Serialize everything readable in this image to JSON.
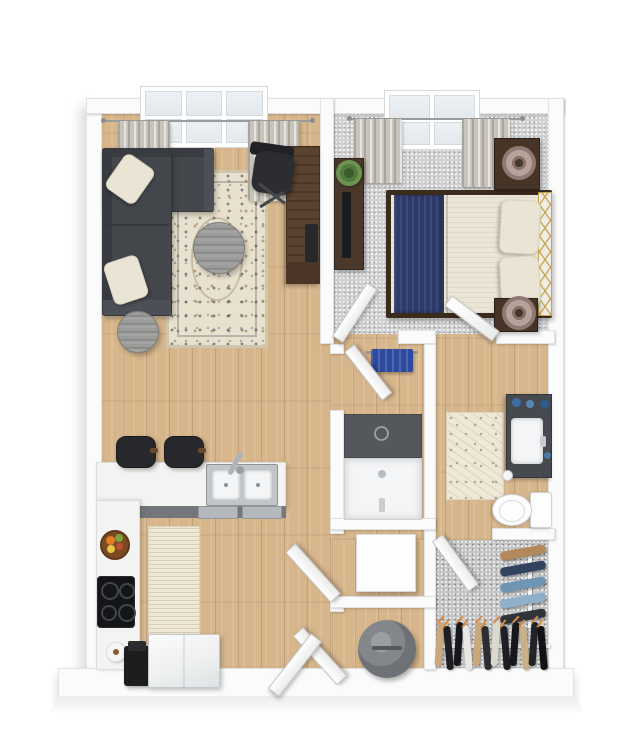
{
  "scene": {
    "type": "3d-floor-plan",
    "view": "top-down",
    "description": "One-bedroom apartment 3D floor plan with living room, bedroom, kitchen, bathroom, walk-in closet and utility closets"
  },
  "palette": {
    "background": "#ffffff",
    "wall": "#fbfbfb",
    "wall_edge": "#e2e2e2",
    "wood_floor": "#d7b68c",
    "carpet_bedroom": "#d0d1d2",
    "carpet_closet": "#c3c4c5",
    "sofa": "#43474c",
    "sofa_shadow": "#383b40",
    "sofa_arm": "#4c5056",
    "pillow_cream": "#e9e4d4",
    "rug_base": "#e8e1cd",
    "table_gray": "#979795",
    "desk_wood": "#5a4330",
    "desk_wood_dark": "#4a3526",
    "chair_black": "#2b2d30",
    "curtain": "#c9c4bb",
    "bed_frame": "#3b2b1c",
    "mattress": "#eae5d6",
    "navy_runner": "#2e3a6a",
    "nightstand": "#463426",
    "lamp_shade": "#b7a19b",
    "console_wood": "#4a382a",
    "tv_black": "#1b1d1f",
    "plant_green": "#527a3c",
    "counter_white": "#f3f3f2",
    "counter_edge": "#73767a",
    "stainless": "#b5b9bd",
    "sink_steel": "#c3c6c9",
    "basin_white": "#f4f5f6",
    "cooktop_black": "#141517",
    "stool_black": "#26282b",
    "stool_arm": "#6b4a2e",
    "fridge_white": "#f0f2f3",
    "bowl_brown": "#7a4a22",
    "fruit_orange": "#e07b28",
    "fruit_green": "#7aa33a",
    "fruit_yellow": "#e8c63f",
    "fruit_red": "#c24d35",
    "coffee_maker": "#1c1d1f",
    "plate_white": "#f6f6f6",
    "towel_blue": "#2d4a9e",
    "tile_dark": "#54575c",
    "tub_white": "#f4f5f6",
    "vanity_dark": "#46494d",
    "toilet_white": "#fdfdfe",
    "soap_blue": "#3b6ea5",
    "washer_white": "#fdfdfd",
    "heater_gray": "#83868a",
    "rod_white": "#f4f4f4",
    "hanger_orange": "#d98a3f",
    "headboard_gold": "#c9a84a"
  },
  "rooms": [
    {
      "name": "living-room",
      "floor": "hardwood",
      "items": [
        "sectional-sofa",
        "throw-pillow",
        "throw-pillow",
        "area-rug",
        "round-coffee-table",
        "round-side-table",
        "desk",
        "office-chair",
        "window",
        "curtains"
      ]
    },
    {
      "name": "bedroom",
      "floor": "carpet",
      "items": [
        "bed",
        "navy-bed-runner",
        "bed-pillow",
        "bed-pillow",
        "gold-trim-headboard",
        "nightstand",
        "nightstand",
        "table-lamp",
        "table-lamp",
        "tv-console",
        "tv",
        "plant",
        "window",
        "curtains",
        "door"
      ]
    },
    {
      "name": "kitchen",
      "floor": "hardwood",
      "items": [
        "l-shaped-counter",
        "double-basin-sink",
        "faucet",
        "dishwasher",
        "bar-stool",
        "bar-stool",
        "cooktop",
        "fruit-bowl",
        "plate",
        "coffee-maker",
        "refrigerator",
        "runner-rug"
      ]
    },
    {
      "name": "bathroom",
      "floor": "hardwood",
      "items": [
        "bathtub-shower",
        "towel-bar",
        "blue-towel",
        "vanity-with-sink",
        "toilet",
        "bath-mat",
        "door"
      ]
    },
    {
      "name": "walk-in-closet",
      "floor": "carpet",
      "items": [
        "clothes-rod",
        "side-clothes-rod",
        "hanging-clothes",
        "door"
      ]
    },
    {
      "name": "utility-closets",
      "floor": "hardwood",
      "items": [
        "washer",
        "water-heater",
        "door",
        "door"
      ]
    },
    {
      "name": "entry",
      "items": [
        "entry-door"
      ]
    }
  ],
  "closet": {
    "bottom_rack": {
      "colors": [
        "#c9a87c",
        "#1d1f22",
        "#15171a",
        "#e9e7e1",
        "#c9a87c",
        "#2b2d31",
        "#dbd8d0",
        "#1d1f22",
        "#15171a",
        "#c9b089",
        "#222428",
        "#101214"
      ],
      "hanger_color": "#d98a3f"
    },
    "side_rack": {
      "colors": [
        "#b3885c",
        "#32435f",
        "#6f95b5",
        "#8fb0ca",
        "#30343a"
      ]
    }
  }
}
